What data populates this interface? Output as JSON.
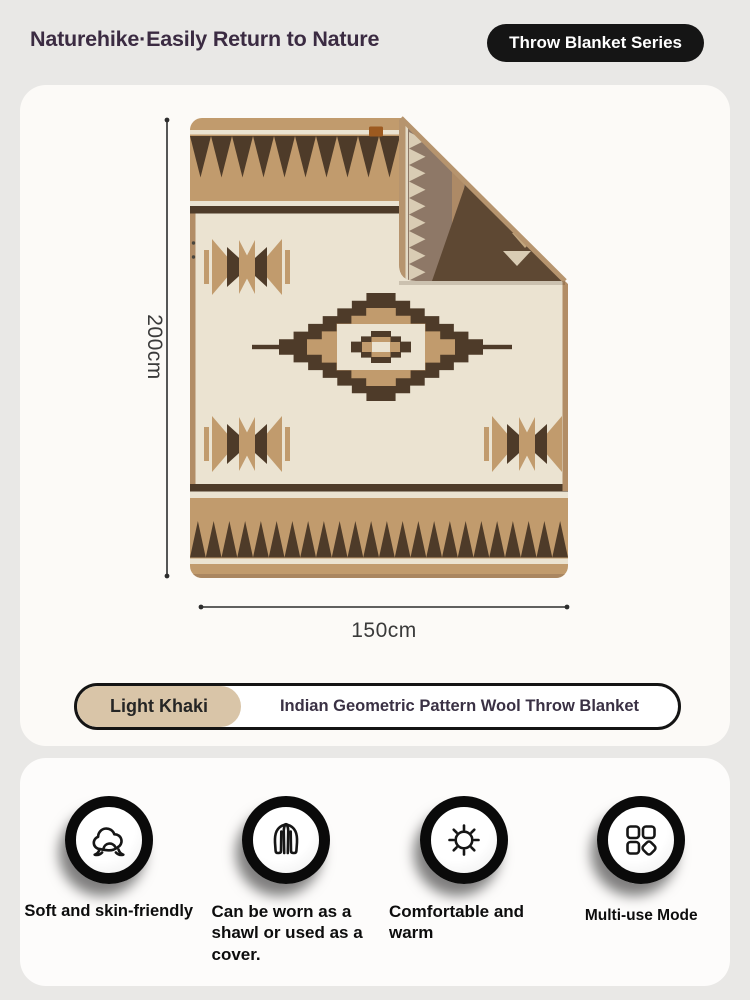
{
  "header": {
    "brand": "Naturehike·Easily Return to Nature",
    "badge": "Throw Blanket Series"
  },
  "product": {
    "height_label": "200cm",
    "width_label": "150cm",
    "variant": {
      "color_name": "Light Khaki",
      "product_name": "Indian Geometric Pattern Wool Throw Blanket"
    }
  },
  "features": [
    {
      "label": "Soft and skin-friendly",
      "icon": "cotton-soft-icon"
    },
    {
      "label": "Can be worn as a shawl or used as a cover.",
      "icon": "shawl-icon"
    },
    {
      "label": "Comfortable and warm",
      "icon": "sun-warm-icon"
    },
    {
      "label": "Multi-use Mode",
      "icon": "multi-use-icon"
    }
  ],
  "colors": {
    "page_bg": "#e9e8e6",
    "card_bg": "#fcfaf7",
    "blanket_tan": "#c19b6d",
    "blanket_dark_brown": "#4e3b29",
    "blanket_cream": "#ebe3d1",
    "blanket_binding": "#b28d66",
    "fold_taupe": "#8e7867",
    "fold_saw_cream": "#d9ccb4",
    "fold_dark_band": "#5e4833",
    "accent_black": "#141414",
    "khaki_chip": "#d9c5a8",
    "title_plum": "#3b2b42",
    "dimension_line": "#2d2d2d"
  }
}
